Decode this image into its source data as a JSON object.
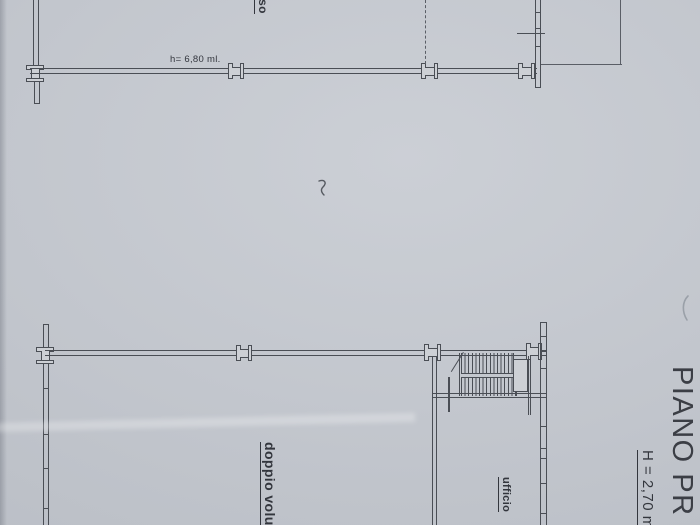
{
  "document": {
    "type": "scanned floor plan drawing",
    "paper_color": "#c6cad1",
    "line_color": "#4a4e55"
  },
  "upper_plan": {
    "room_label_fragment": "sso",
    "height_note": "h= 6,80 ml."
  },
  "lower_plan": {
    "double_volume_label": "doppio volu",
    "office_label": "ufficio",
    "title": "PIANO PR",
    "height_note": "H = 2,70 m"
  }
}
